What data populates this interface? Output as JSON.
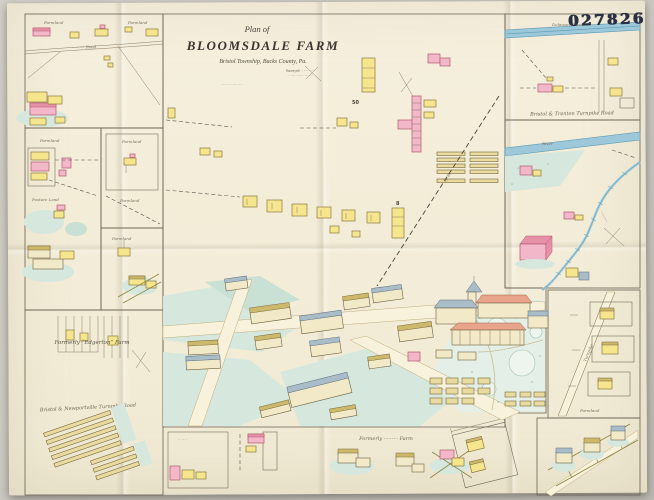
{
  "stamp": {
    "number": "027826"
  },
  "title": {
    "plan_of": "Plan of",
    "name": "BLOOMSDALE FARM",
    "location": "Bristol Township, Bucks County, Pa.",
    "fine1": "Surveyed ·· ···· ····",
    "fine2": "·· ····· ···· ···· ···",
    "fine3": "····· ······ · ···"
  },
  "labels": {
    "farmland_left_top_1": "Farmland",
    "farmland_left_top_2": "Farmland",
    "road_left_top": "·········· Road",
    "farmland_left_mid": "Farmland",
    "pasture": "Pasture Land",
    "farmland_nested": "Farmland",
    "farmland_nested_2": "Farmland",
    "farmland_left_lower": "Farmland",
    "edgerton": "Formerly “Edgerton” Farm",
    "newportville_road": "Bristol & Newportville Turnpike Road",
    "river_top": "Delaware  River",
    "turnpike": "Bristol & Trenton Turnpike Road",
    "river_mid": "River",
    "stream_script": "··········",
    "strip_road_script": "Turnpike",
    "farmland_strip": "Farmland",
    "formerly_farm": "Formerly ········· Farm",
    "railroad": "R. R.",
    "plan_number_50": "50",
    "plan_number_8": "8",
    "bottom_box_script": "·· ····"
  },
  "colors": {
    "backdrop": "#ccc9c2",
    "paper": "#f3edd9",
    "panel_line": "#6a6153",
    "building_yellow": "#f5e68e",
    "building_pink": "#f2b7c9",
    "roof_slate": "#a9bdc9",
    "roof_salmon": "#e8a58c",
    "water_blue": "#9cc8da",
    "field_green": "#d6e8de",
    "stamp_ink": "#2b3044"
  }
}
